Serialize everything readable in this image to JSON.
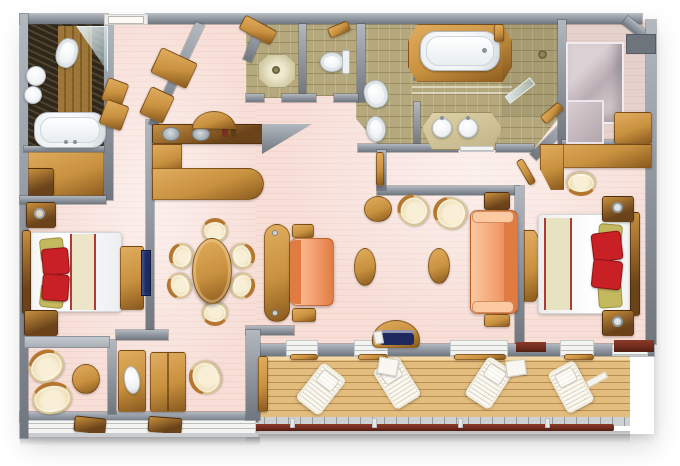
{
  "meta": {
    "kind": "floor-plan",
    "subject": "two-bedroom suite with veranda, top-down 3D rendered plan",
    "canvas": {
      "width": 680,
      "height": 466
    }
  },
  "palette": {
    "wall": "#8d939c",
    "wallDark": "#70767e",
    "wallLight": "#b2b8bf",
    "floorPink": "#f7ded7",
    "floorMauve": "#e6d2cc",
    "tileBeige": "#b4a87c",
    "marble": "#30271b",
    "wood": "#c8913f",
    "woodLight": "#e0ac5e",
    "woodDark": "#8a5a1e",
    "woodDeep": "#6b431a",
    "cream": "#efe2ba",
    "creamDark": "#d9c491",
    "trimWood": "#b5772e",
    "orange": "#f4a071",
    "orangeDark": "#e07c42",
    "orangeLight": "#fbc9a2",
    "red": "#c92026",
    "olive": "#c4b95f",
    "deck": "#e3bd7d",
    "rail": "#6f2b1d",
    "tileStrip": "#cdd1d4",
    "tv": "#1e2a5f",
    "steel": "#9aa4aa",
    "white": "#ffffff"
  },
  "rooms": [
    {
      "id": "guest-bathroom",
      "items": [
        "toilet",
        "twin-round-sinks",
        "bathtub",
        "glass-shower"
      ]
    },
    {
      "id": "wardrobe-closet",
      "items": [
        "cabinets",
        "drawers"
      ]
    },
    {
      "id": "guest-bedroom",
      "items": [
        "queen-bed",
        "red-pillows",
        "nightstand",
        "dresser",
        "wall-tv",
        "cabinet"
      ]
    },
    {
      "id": "sitting-nook",
      "items": [
        "two-cream-armchairs",
        "round-side-table"
      ]
    },
    {
      "id": "entry-foyer",
      "items": [
        "entry-door",
        "two-angled-closets"
      ]
    },
    {
      "id": "guest-shower-room",
      "items": [
        "shower-pan"
      ]
    },
    {
      "id": "guest-wc",
      "items": [
        "toilet"
      ]
    },
    {
      "id": "bar-pantry",
      "items": [
        "counter-with-twin-basins",
        "arched-cabinet",
        "l-shaped-cabinet"
      ]
    },
    {
      "id": "dining-area",
      "items": [
        "oval-wood-table",
        "six-cream-chairs"
      ]
    },
    {
      "id": "living-room",
      "items": [
        "orange-loveseat",
        "orange-sofa",
        "two-tub-chairs",
        "round-table",
        "two-oval-coffee-tables",
        "side-tables",
        "window-bench-with-navy-cushion"
      ]
    },
    {
      "id": "master-bathroom",
      "items": [
        "bathtub-in-wood-surround",
        "double-vanity-sinks",
        "toilet",
        "bidet",
        "walk-in-shower"
      ]
    },
    {
      "id": "walk-in-closet",
      "items": [
        "mirrored-wardrobe",
        "wood-dresser"
      ]
    },
    {
      "id": "master-bedroom",
      "items": [
        "king-bed",
        "red-pillows",
        "two-nightstands-with-lamps",
        "vanity-desk",
        "stool",
        "half-round-console"
      ]
    },
    {
      "id": "veranda",
      "items": [
        "teak-deck",
        "four-white-loungers",
        "two-white-side-tables",
        "privacy-screen",
        "railing"
      ]
    }
  ]
}
